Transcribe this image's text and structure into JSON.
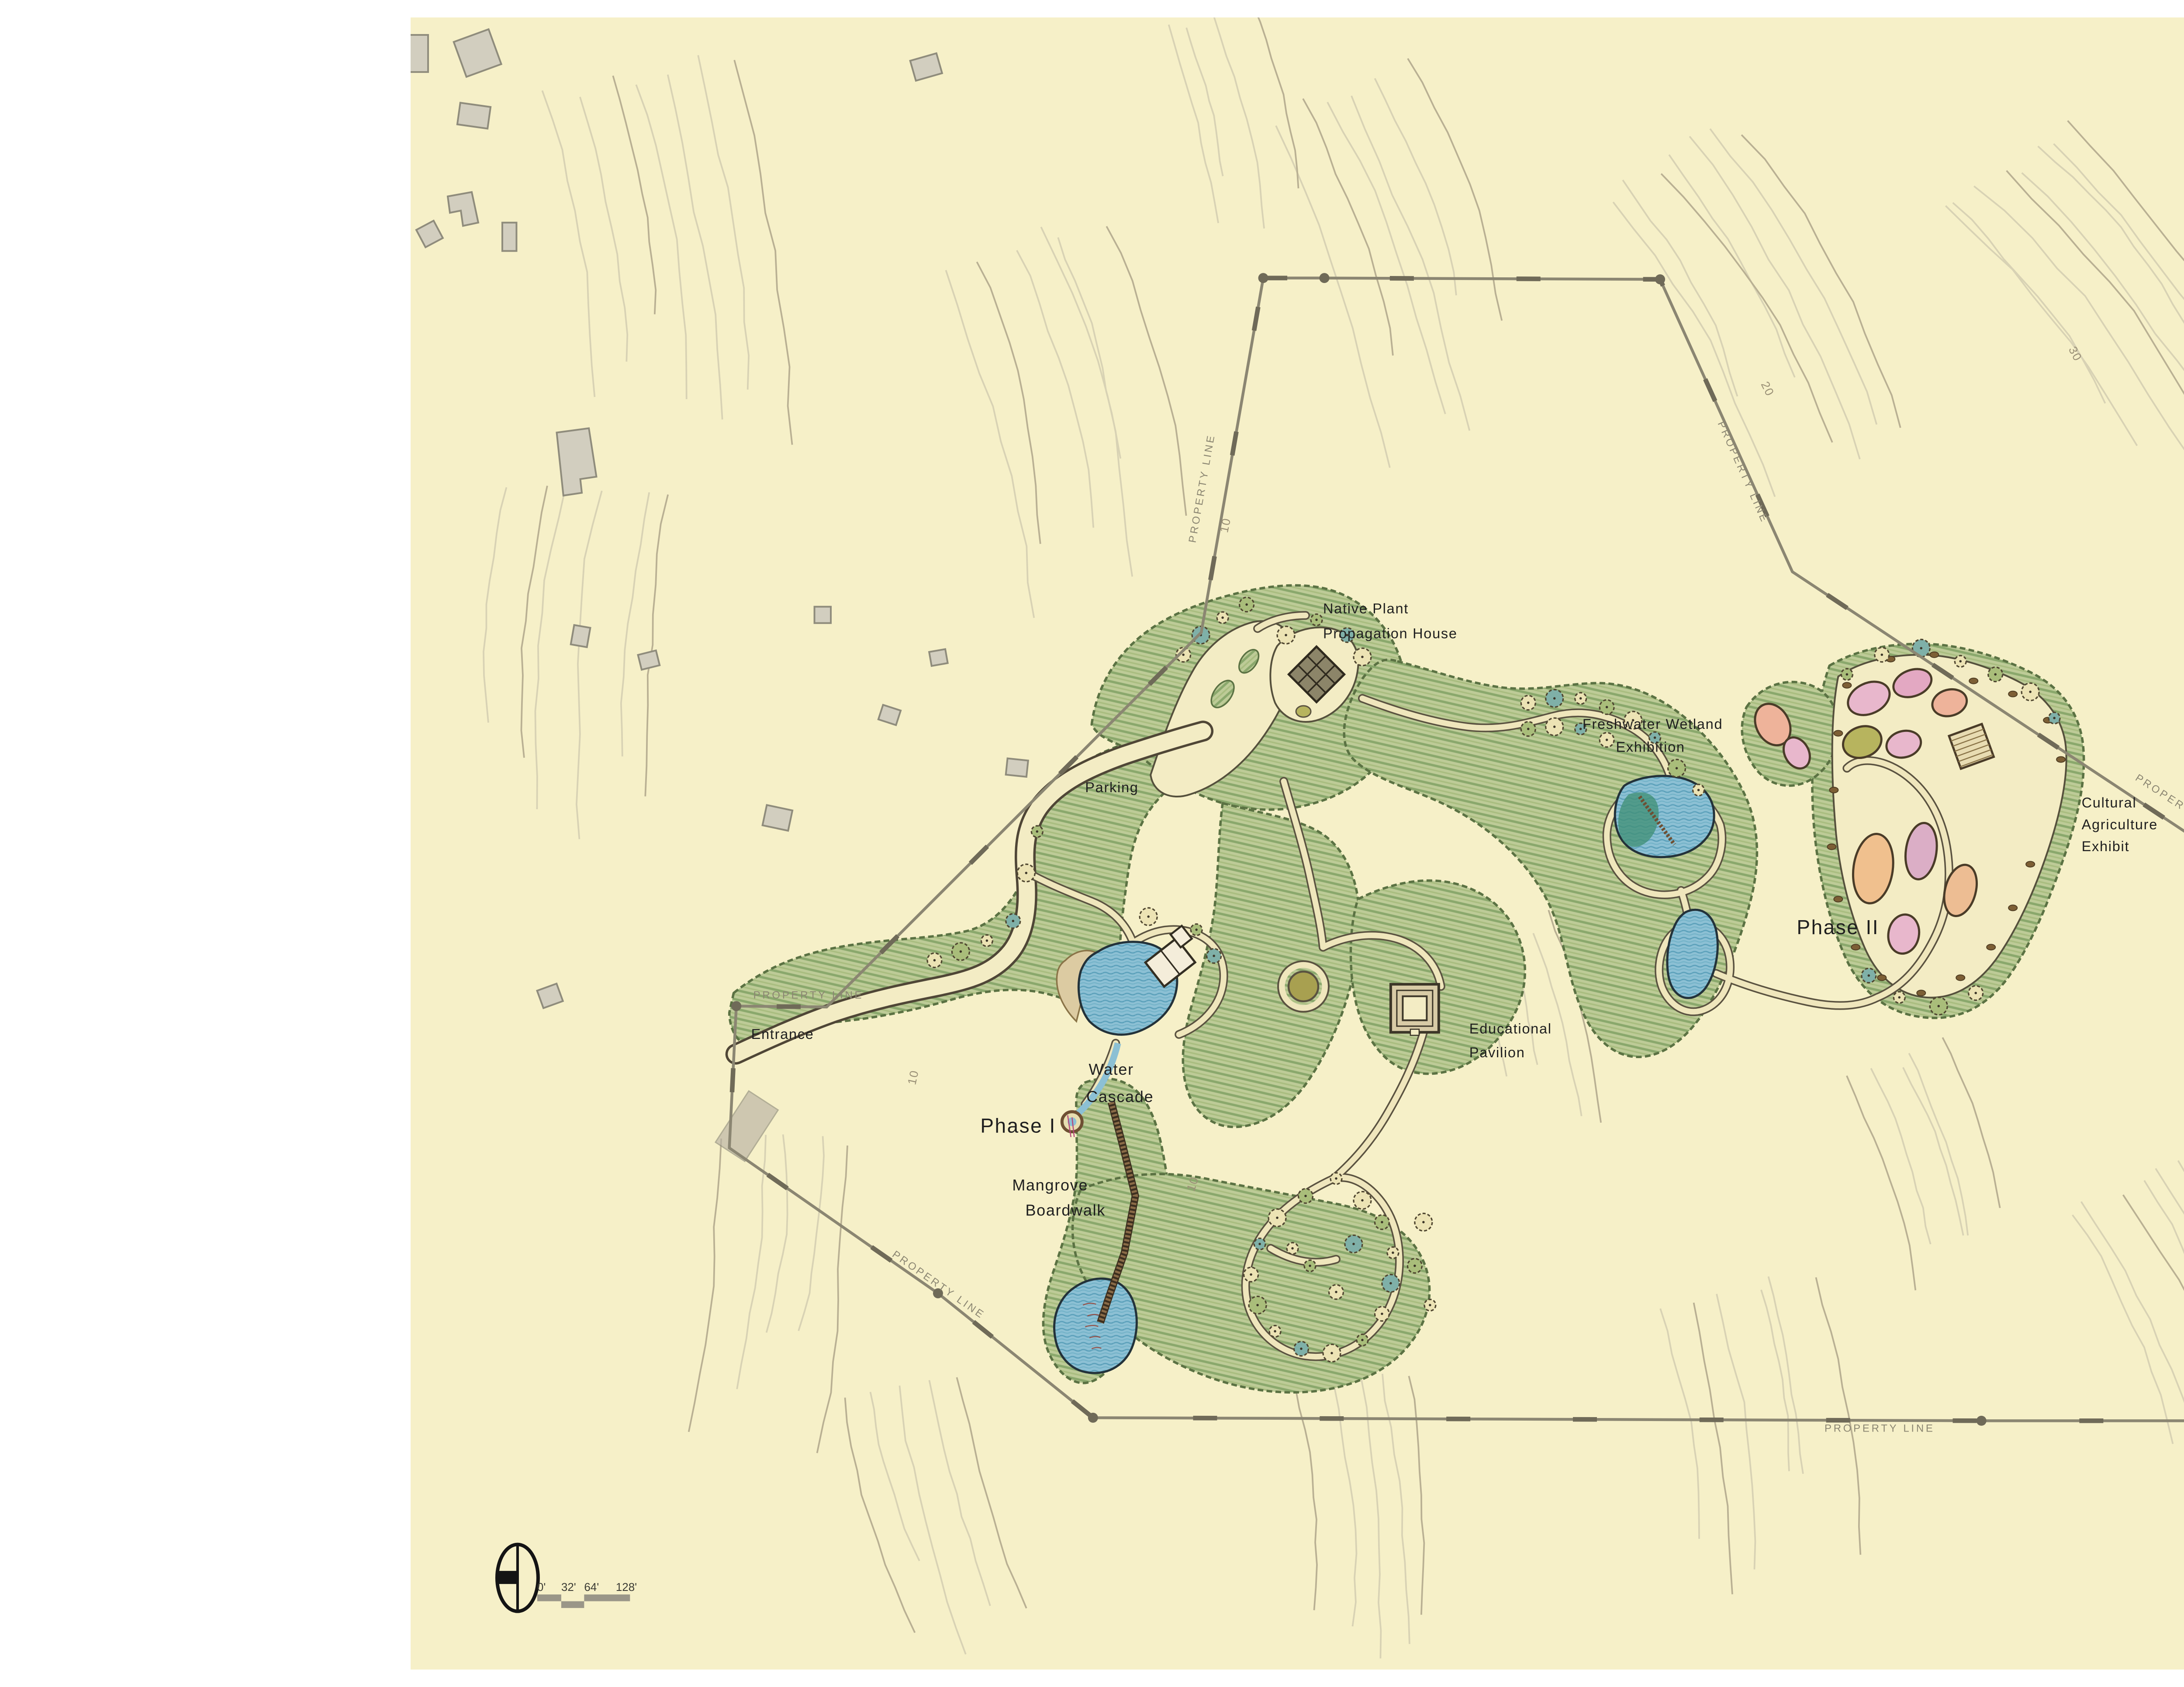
{
  "page": {
    "background": "#ffffff",
    "paper_color": "#f6f0c8"
  },
  "plan_labels": {
    "native_plant": {
      "line1": "Native Plant",
      "line2": "Propagation House"
    },
    "parking": "Parking",
    "freshwater": {
      "line1": "Freshwater Wetland",
      "line2": "Exhibition"
    },
    "cultural": {
      "line1": "Cultural",
      "line2": "Agriculture",
      "line3": "Exhibit"
    },
    "phase2": "Phase II",
    "phase1": "Phase I",
    "entrance": "Entrance",
    "water_cascade": {
      "line1": "Water",
      "line2": "Cascade"
    },
    "mangrove": {
      "line1": "Mangrove",
      "line2": "Boardwalk"
    },
    "educational": {
      "line1": "Educational",
      "line2": "Pavilion"
    },
    "ethans_tower": "Ethan’s Tower"
  },
  "property_line_label": "PROPERTY LINE",
  "contour_labels": {
    "v10": "10",
    "v20": "20",
    "v30": "30",
    "v40": "40",
    "v50": "50"
  },
  "scale_bar": {
    "ticks": [
      "0'",
      "32'",
      "64'",
      "128'"
    ]
  },
  "colors": {
    "paper": "#f6f0c8",
    "contour_light": "#d8d2b4",
    "contour_dark": "#b9b093",
    "property_line": "#8b8672",
    "green_base": "#bdcb97",
    "water": "#8cc0d4",
    "bed_pink": "#e8b7cc",
    "bed_salmon": "#eeb39a",
    "bed_olive": "#b7b45e",
    "bed_peach": "#f0c08e",
    "building_gray": "#d2cebf"
  }
}
